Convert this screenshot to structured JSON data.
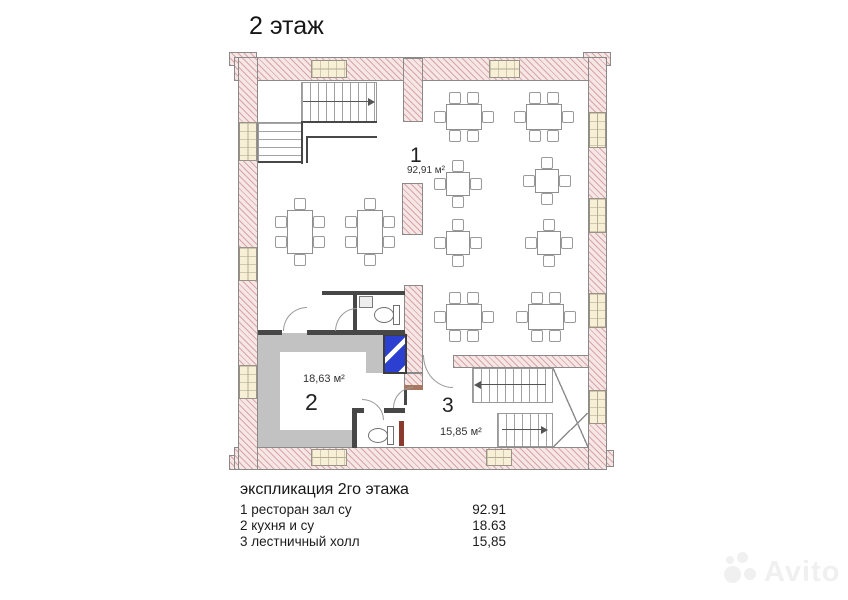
{
  "page": {
    "title": "2 этаж"
  },
  "plan": {
    "rooms": [
      {
        "number": "1",
        "area_label": "92,91 м²"
      },
      {
        "number": "2",
        "area_label": "18,63 м²"
      },
      {
        "number": "3",
        "area_label": "15,85 м²"
      }
    ]
  },
  "legend": {
    "title": "экспликация 2го этажа",
    "rows": [
      {
        "name": "1 ресторан  зал су",
        "value": "92.91"
      },
      {
        "name": "2 кухня и су",
        "value": "18.63"
      },
      {
        "name": "3 лестничный холл",
        "value": "15,85"
      }
    ]
  },
  "watermark": {
    "text": "Avito"
  },
  "colors": {
    "wall_fill": "#f6e6e6",
    "wall_hatch": "#c88282",
    "counter_gray": "#c2c2c2",
    "unit_blue": "#2b3fd0",
    "window_fill": "#f7f0d6"
  }
}
